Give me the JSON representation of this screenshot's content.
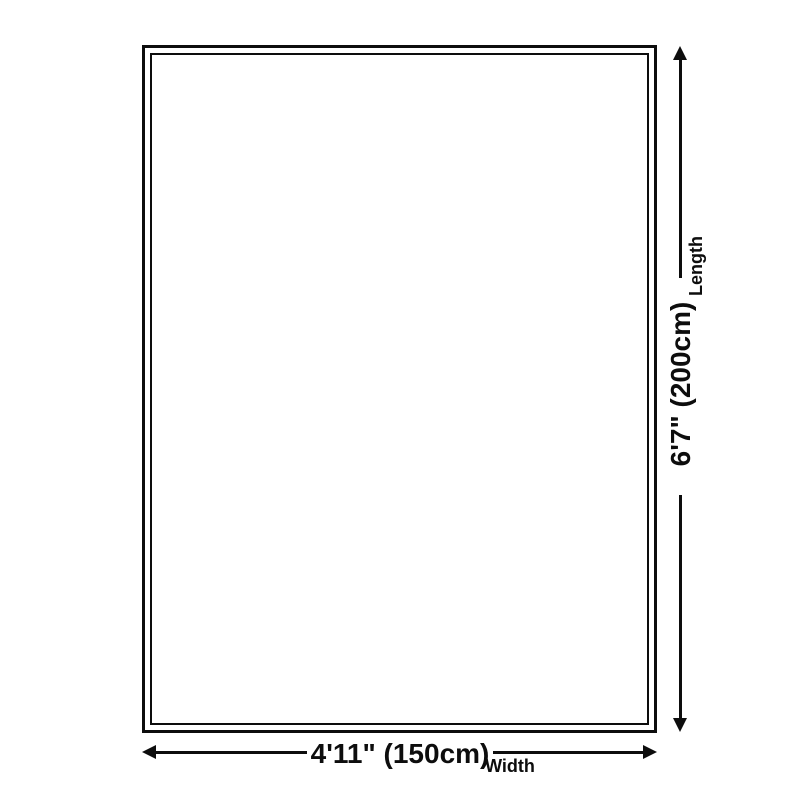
{
  "diagram": {
    "type": "product-size-diagram",
    "colors": {
      "line": "#0d0d0d",
      "background": "#ffffff"
    },
    "dimensions": {
      "length": {
        "value": "6'7\" (200cm)",
        "label": "Length"
      },
      "width": {
        "value": "4'11\" (150cm)",
        "label": "Width"
      }
    }
  }
}
